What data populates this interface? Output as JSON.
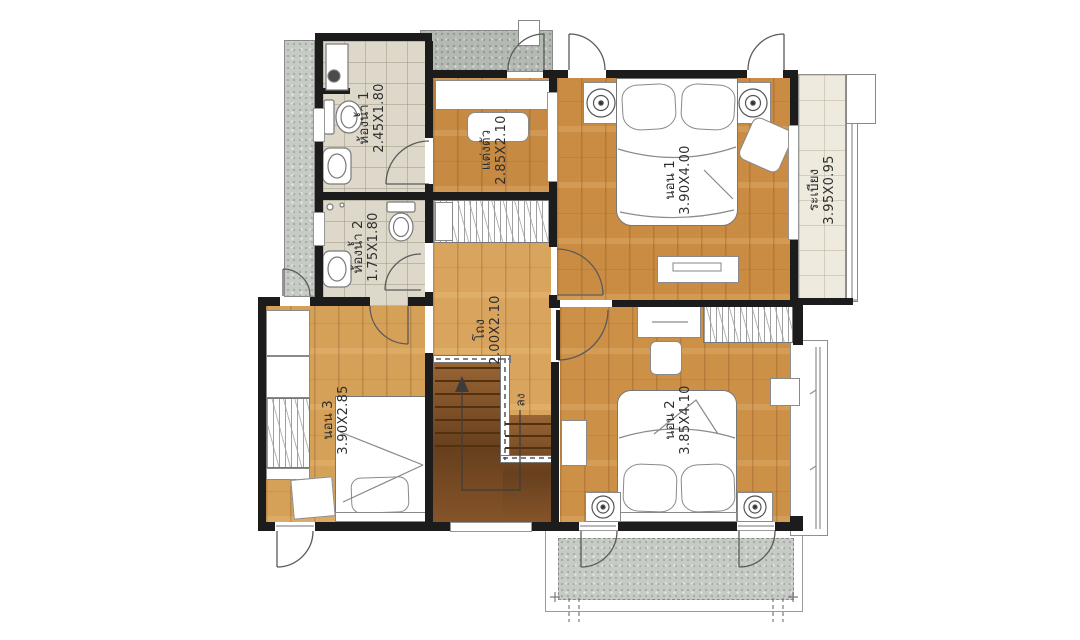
{
  "rooms": {
    "bathroom1": {
      "name": "ห้องน้ำ 1",
      "dims": "2.45X1.80"
    },
    "bathroom2": {
      "name": "ห้องน้ำ 2",
      "dims": "1.75X1.80"
    },
    "dressing": {
      "name": "แต่งตัว",
      "dims": "2.85X2.10"
    },
    "bedroom1": {
      "name": "นอน 1",
      "dims": "3.90X4.00"
    },
    "balcony": {
      "name": "ระเบียง",
      "dims": "3.95X0.95"
    },
    "hall": {
      "name": "โถง",
      "dims": "2.00X2.10"
    },
    "bedroom3": {
      "name": "นอน 3",
      "dims": "3.90X2.85"
    },
    "bedroom2": {
      "name": "นอน 2",
      "dims": "3.85X4.10"
    }
  },
  "stairs": {
    "down_label": "ลง"
  },
  "colors": {
    "wall": "#1c1c1c",
    "wood_floor": "#cf9248",
    "stair_wood": "#7c4e26",
    "bath_tile": "#ddd8ca",
    "balcony_tile": "#efeade",
    "concrete": "#c6cbc5",
    "label_text": "#2e2e2e"
  }
}
